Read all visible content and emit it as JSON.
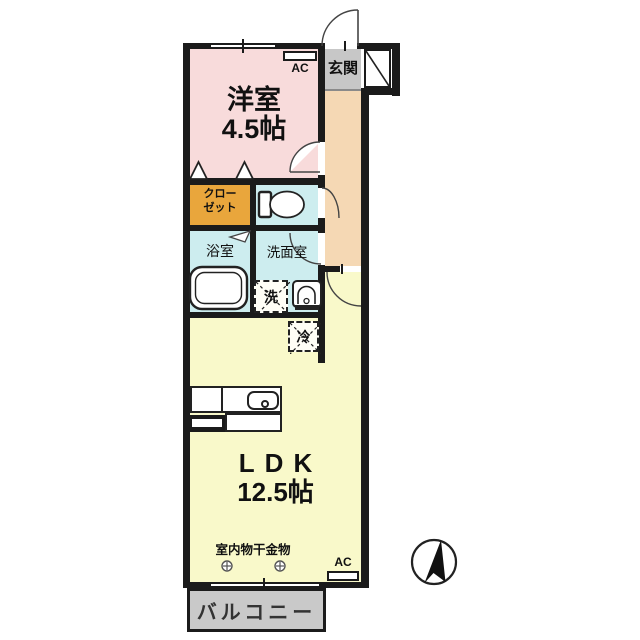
{
  "floorplan": {
    "rooms": {
      "western_room": {
        "label": "洋室",
        "size": "4.5帖"
      },
      "entrance": {
        "label": "玄関"
      },
      "closet": {
        "label": "クローゼット",
        "lines": [
          "クロー",
          "ゼット"
        ]
      },
      "bathroom": {
        "label": "浴室"
      },
      "washroom": {
        "label": "洗面室"
      },
      "ldk": {
        "label": "LDK",
        "size": "12.5帖"
      },
      "balcony": {
        "label": "バルコニー"
      }
    },
    "fixtures": {
      "washing_machine": {
        "label": "洗"
      },
      "refrigerator": {
        "label": "冷"
      },
      "air_conditioner": {
        "label": "AC"
      },
      "indoor_laundry_hardware": {
        "label": "室内物干金物"
      }
    },
    "symbols": {
      "compass": "north-arrow"
    },
    "colors": {
      "wall": "#1b1b1b",
      "western_room": "#f8dbdb",
      "hallway": "#f5d8b4",
      "entrance": "#c7c7c7",
      "closet": "#e9a63c",
      "wet_rooms": "#cdedef",
      "ldk": "#f9f9ca",
      "balcony": "#c9c9c9"
    }
  }
}
